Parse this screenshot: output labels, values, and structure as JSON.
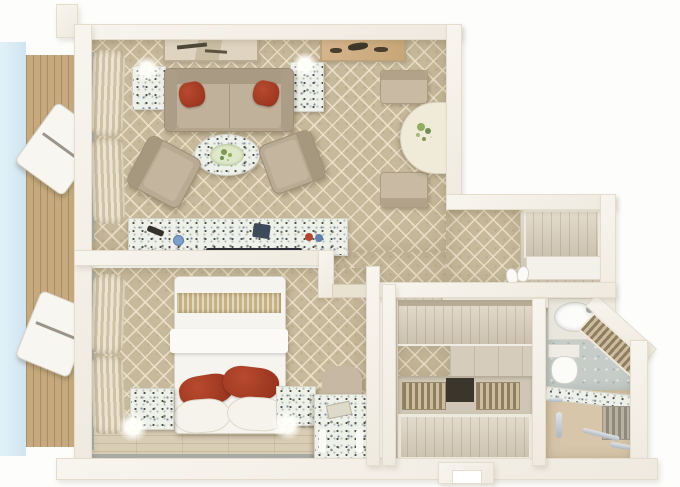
{
  "palette": {
    "background": "#ffffff",
    "wall": "#f4f1e9",
    "wall_shadow": "#ddd6c6",
    "carpet": "#c7b99b",
    "carpet_lattice": "#eee4cc",
    "wood_floor": "#d9cdb6",
    "balcony_deck": "#c6aa7e",
    "sky": "#d7eaf5",
    "sofa_taupe": "#b9aa93",
    "accent_pillow_red": "#a53a24",
    "granite_speckle_base": "#eef0ea",
    "gold_bed_runner": "#c6b283",
    "bed_linen": "#f6f4ee",
    "bathroom_tile": "#c6cdc9",
    "chrome_fixture": "#c3cad0",
    "plant_green": "#7d9a55",
    "closet_wood": "#d8cdb9"
  },
  "scene": {
    "type": "3d-floorplan-render",
    "rooms": [
      {
        "id": "living-room",
        "furniture": [
          "sofa",
          "red-accent-pillows",
          "side-table-left",
          "side-table-right",
          "table-lamps",
          "oval-coffee-table",
          "armchair-left",
          "armchair-right",
          "dining-half-table",
          "dining-chairs",
          "flower-vase",
          "wall-art-left",
          "wall-art-right",
          "curtains",
          "tv-console"
        ]
      },
      {
        "id": "bedroom",
        "furniture": [
          "double-bed",
          "gold-runner",
          "red-accent-pillows",
          "white-pillows",
          "nightstand-left",
          "nightstand-right",
          "bed-lamps",
          "vanity-desk",
          "desk-chair",
          "curtains",
          "wood-floor-strip"
        ]
      },
      {
        "id": "entry-hall",
        "furniture": [
          "entry-closet-panel",
          "entry-shelf",
          "bench",
          "slippers",
          "wood-entry-floor"
        ]
      },
      {
        "id": "walk-in-closet",
        "furniture": [
          "wardrobe-top",
          "shelf-row",
          "shoe-rack-left",
          "shoe-rack-right",
          "hamper",
          "wardrobe-bottom"
        ]
      },
      {
        "id": "bathroom",
        "furniture": [
          "vanity-sink",
          "toilet",
          "diagonal-towel-shelf",
          "granite-partition",
          "radiator",
          "grab-bars"
        ]
      },
      {
        "id": "balcony",
        "furniture": [
          "deck",
          "lounger-upper",
          "lounger-lower"
        ]
      }
    ]
  }
}
